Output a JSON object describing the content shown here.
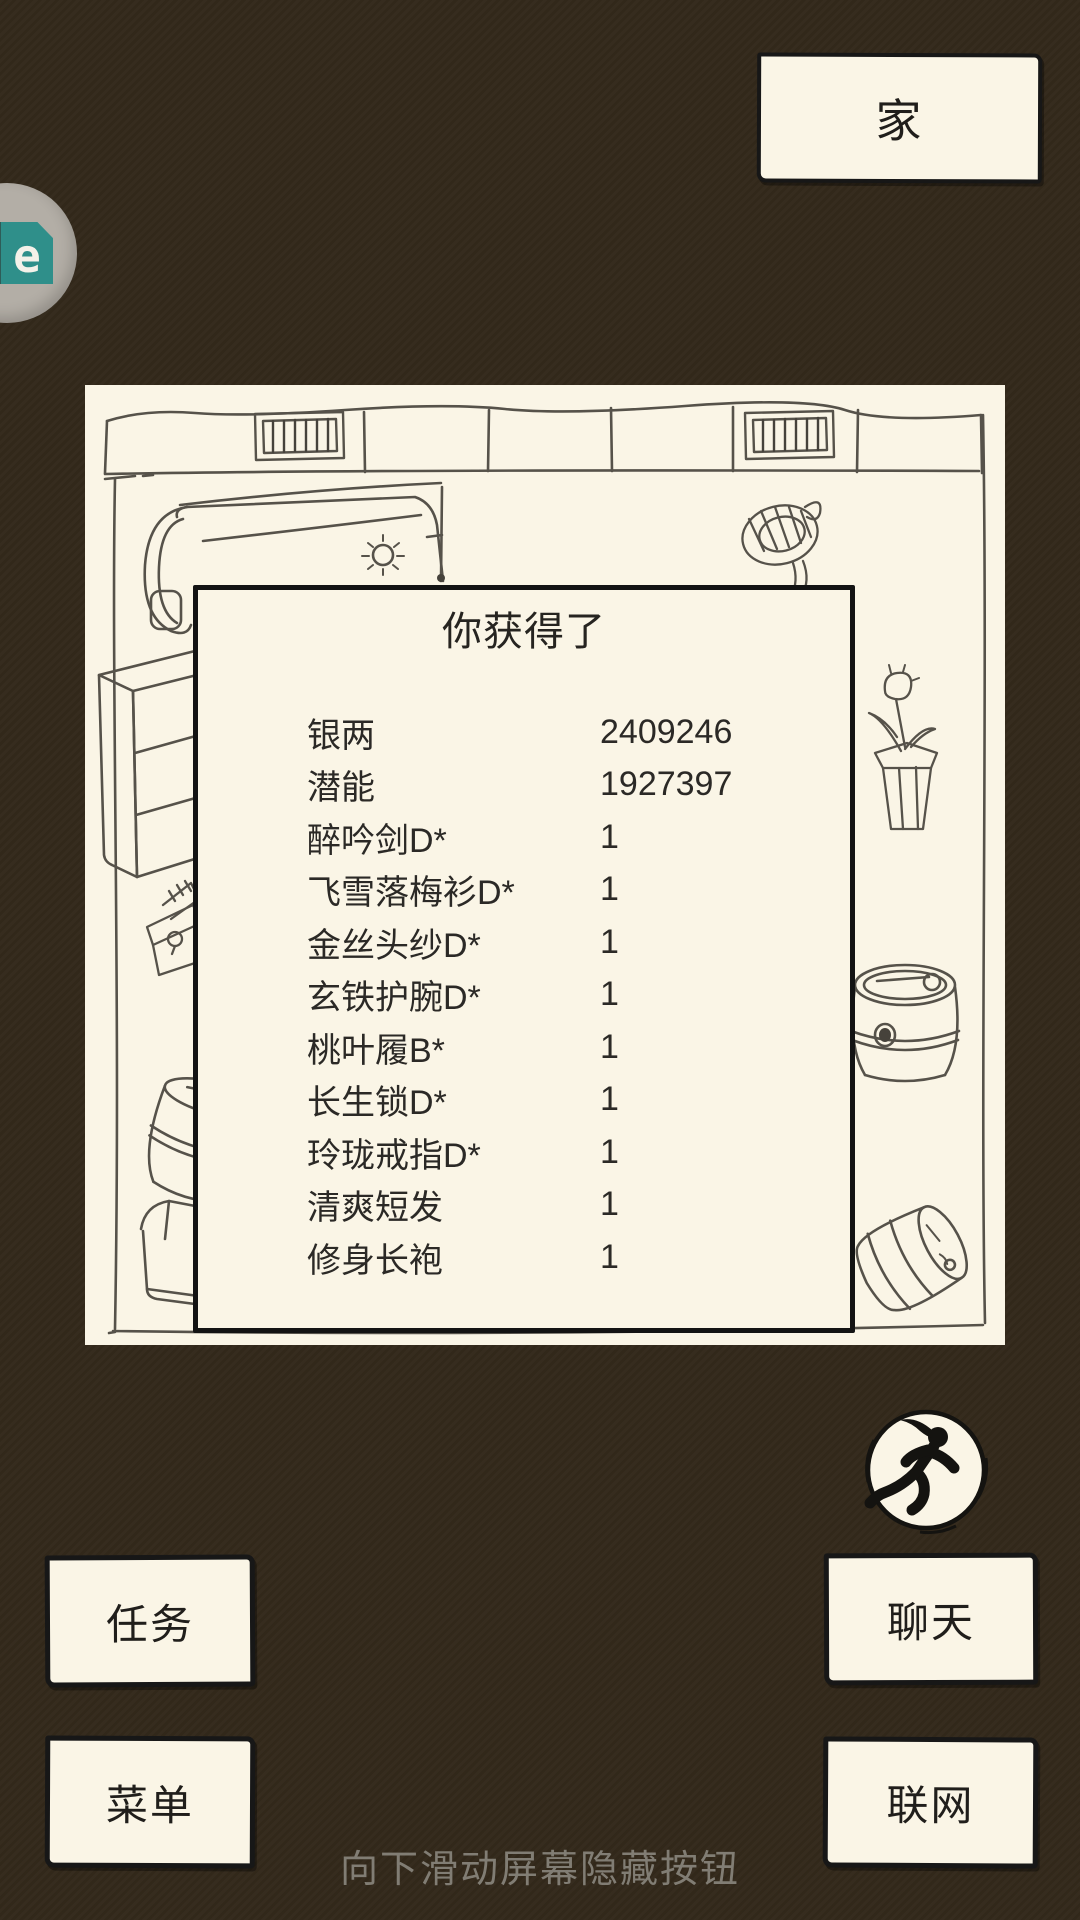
{
  "colors": {
    "background": "#33291b",
    "paper": "#faf5e6",
    "ink": "#24221f",
    "sketch_line": "#56524a",
    "hint_text": "#817d74",
    "logo_teal": "#2f8f8a",
    "logo_dark_teal": "#2e5c58",
    "logo_orange": "#d89a3f"
  },
  "header": {
    "home_label": "家"
  },
  "overlay_icon": {
    "name": "floating-app-icon",
    "visible_letter": "e"
  },
  "dialog": {
    "title": "你获得了",
    "items": [
      {
        "name": "银两",
        "count": "2409246"
      },
      {
        "name": "潜能",
        "count": "1927397"
      },
      {
        "name": "醉吟剑D*",
        "count": "1"
      },
      {
        "name": "飞雪落梅衫D*",
        "count": "1"
      },
      {
        "name": "金丝头纱D*",
        "count": "1"
      },
      {
        "name": "玄铁护腕D*",
        "count": "1"
      },
      {
        "name": "桃叶履B*",
        "count": "1"
      },
      {
        "name": "长生锁D*",
        "count": "1"
      },
      {
        "name": "玲珑戒指D*",
        "count": "1"
      },
      {
        "name": "清爽短发",
        "count": "1"
      },
      {
        "name": "修身长袍",
        "count": "1"
      }
    ]
  },
  "buttons": {
    "tasks": "任务",
    "menu": "菜单",
    "chat": "聊天",
    "network": "联网"
  },
  "icons": {
    "runner": "runner-icon",
    "floating_assistant": "floating-app-icon"
  },
  "hint": "向下滑动屏幕隐藏按钮"
}
